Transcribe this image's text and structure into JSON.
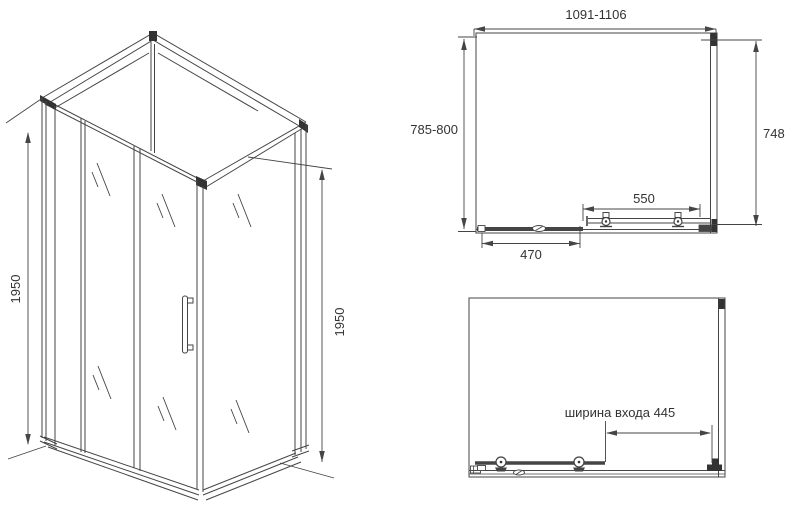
{
  "drawing": {
    "type": "shower-enclosure-dimension-drawing",
    "colors": {
      "background": "#ffffff",
      "line": "#454545",
      "dark_fill": "#333333",
      "text": "#333333"
    },
    "isometric_view": {
      "description": "corner shower enclosure with sliding door",
      "height_left": "1950",
      "height_right": "1950"
    },
    "plan_view": {
      "width_range": "1091-1106",
      "depth_range": "785-800",
      "side_panel": "748",
      "inner_span": "550",
      "door_span": "470"
    },
    "front_view": {
      "entrance_width": "ширина входа 445"
    }
  }
}
